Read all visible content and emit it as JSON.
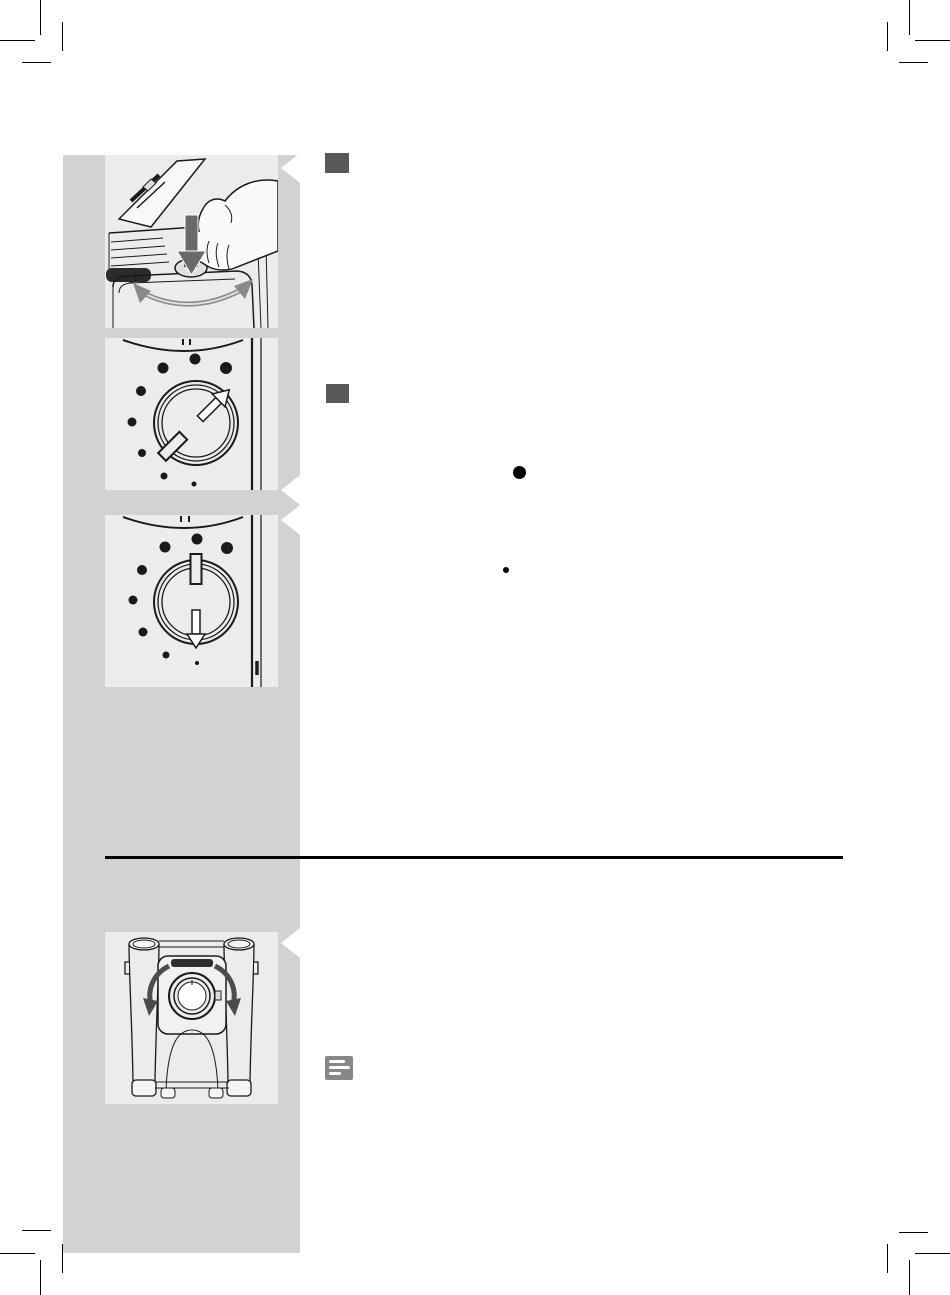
{
  "colors": {
    "page_bg": "#ffffff",
    "sidebar_bg": "#d2d2d2",
    "figure_bg": "#ececec",
    "line_art": "#1a1a1a",
    "step_marker": "#58585a",
    "press_arrow": "#6a6a6a",
    "rotate_arrow": "#8a8a8a",
    "note_icon_bg": "#87888a",
    "divider": "#000000",
    "bullet": "#000000",
    "crop_mark": "#000000"
  },
  "icons": [
    "press-down-arrow-icon",
    "rotate-arrows-icon",
    "dial-pointer-arrow-icon",
    "dial-down-arrow-icon",
    "spout-rotate-arrows-icon",
    "note-icon",
    "callout-notch-icon"
  ],
  "figures": [
    {
      "name": "grinder-adjustment-press-figure"
    },
    {
      "name": "grind-dial-turned-figure"
    },
    {
      "name": "grind-dial-down-figure"
    },
    {
      "name": "dispensing-spout-rotate-figure"
    }
  ],
  "step_markers": [
    {
      "index": 1
    },
    {
      "index": 2
    }
  ],
  "bullets": [
    {
      "size": "large"
    },
    {
      "size": "small"
    }
  ]
}
